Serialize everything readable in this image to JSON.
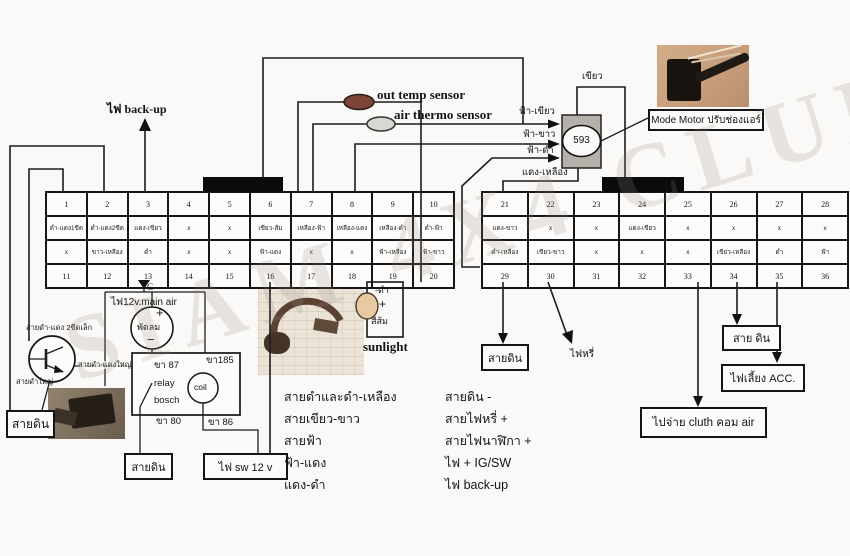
{
  "watermark": "SIAM 4X4 CLUB",
  "colors": {
    "sensor_brown": "#7d4438",
    "sensor_gray": "#d8d7d2",
    "sensor_tan": "#e8c9a2",
    "node_box_gray": "#b5b1aa",
    "wire_black": "#1c1c1c"
  },
  "labels": {
    "backup": "ไฟ back-up",
    "out_temp": "out temp sensor",
    "air_thermo": "air thermo sensor",
    "fa_green": "ฟ้า-เขียว",
    "fa_white": "ฟ้า-ขาว",
    "fa_black": "ฟ้า-ดำ",
    "red_yellow": "แดง-เหลือง",
    "green": "เขียว",
    "node": "593",
    "mode_motor": "Mode Motor ปรับช่องแอร์",
    "ground_marker": "G",
    "fan_supply": "ไฟ12v.main air",
    "fan": "พัดลม",
    "plus": "+",
    "minus": "−",
    "tr_small": "สายดำ-แดง 2ขีดเล็ก",
    "tr_big": "สายดำ-แดงใหญ่",
    "tr_black": "สายดำใหญ่",
    "relay_pin87": "ขา 87",
    "relay_name": "relay",
    "relay_brand": "bosch",
    "relay_pin80": "ขา 80",
    "relay_pin85": "ขา185",
    "coil": "coil",
    "relay_pin86": "ขา 86",
    "ground": "สายดิน",
    "ground_spaced": "สาย ดิน",
    "fai_sw": "ไฟ sw 12 v",
    "sun_neg": "-ดำ",
    "sun_plus": "+",
    "sun_color": "สีส้ม",
    "sunlight": "sunlight",
    "fai_ri": "ไฟหรี่",
    "fai_liang": "ไฟเลี้ยง ACC.",
    "pai_jai": "ไปจ่าย cluth คอม air"
  },
  "connector_left": {
    "pins_top": [
      "1",
      "2",
      "3",
      "4",
      "5",
      "6",
      "7",
      "8",
      "9",
      "10"
    ],
    "row2": [
      "ดำ-แดง1ขีด",
      "ดำ-แดง2ขีด",
      "แดง-เขียว",
      "x",
      "x",
      "เขียว-ส้ม",
      "เหลือง-ฟ้า",
      "เหลือง-แดง",
      "เหลือง-ดำ",
      "ดำ-ฟ้า"
    ],
    "row3": [
      "x",
      "ขาว-เหลือง",
      "ดำ",
      "x",
      "x",
      "ฟ้า-แดง",
      "x",
      "x",
      "ฟ้า-เหลือง",
      "ฟ้า-ขาว"
    ],
    "pins_bottom": [
      "11",
      "12",
      "13",
      "14",
      "15",
      "16",
      "17",
      "18",
      "19",
      "20"
    ]
  },
  "connector_right": {
    "pins_top": [
      "21",
      "22",
      "23",
      "24",
      "25",
      "26",
      "27",
      "28"
    ],
    "row2": [
      "แดง-ขาว",
      "x",
      "x",
      "แดง-เขียว",
      "x",
      "x",
      "x",
      "x"
    ],
    "row3": [
      "ดำ-เหลือง",
      "เขียว-ขาว",
      "x",
      "x",
      "x",
      "เขียว-เหลือง",
      "ดำ",
      "ฟ้า"
    ],
    "pins_bottom": [
      "29",
      "30",
      "31",
      "32",
      "33",
      "34",
      "35",
      "36"
    ]
  },
  "notes_left": [
    "สายดำและดำ-เหลือง",
    "สายเขียว-ขาว",
    "สายฟ้า",
    "ฟ้า-แดง",
    "แดง-ดำ"
  ],
  "notes_right": [
    "สายดิน -",
    "สายไฟหรี่ +",
    "สายไฟนาฬิกา +",
    "ไฟ + IG/SW",
    "ไฟ back-up"
  ]
}
